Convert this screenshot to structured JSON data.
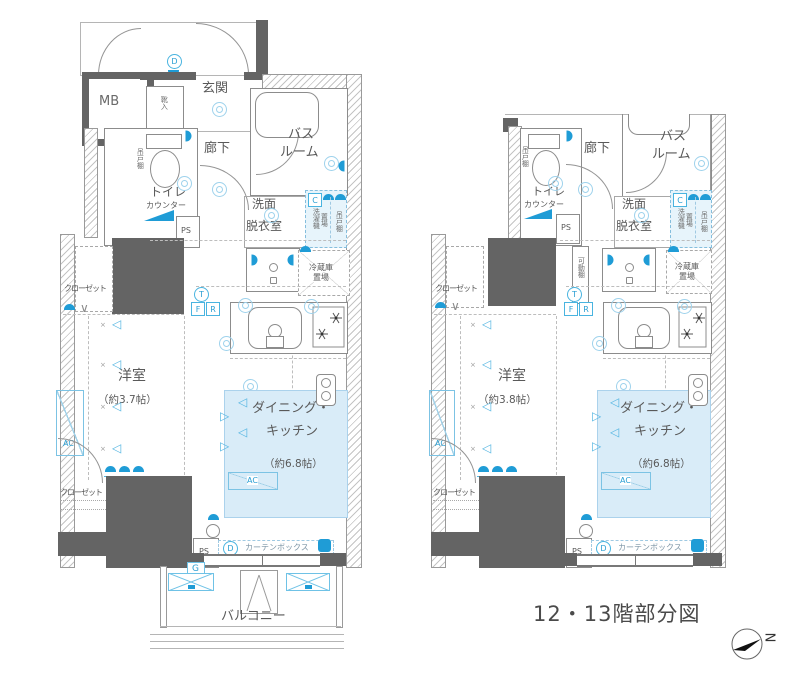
{
  "caption": "12・13階部分図",
  "compass": {
    "label": "N"
  },
  "glyphs": {
    "sconce": "◁",
    "cross": "×",
    "check": "∨"
  },
  "labels": {
    "mb": "MB",
    "entrance": "玄関",
    "shoe_box": "靴入",
    "corridor": "廊下",
    "bath_1": "バス",
    "bath_2": "ルーム",
    "toilet": "トイレ",
    "counter": "カウンター",
    "ps": "PS",
    "wash_1": "洗面",
    "wash_2": "脱衣室",
    "c_mark": "C",
    "washer_1": "洗濯機",
    "washer_2": "置場",
    "hanging_shelf": "吊戸棚",
    "fridge_1": "冷蔵庫",
    "fridge_2": "置場",
    "movable_shelf": "可動棚",
    "closet": "クローゼット",
    "western_room": "洋室",
    "dk_1": "ダイニング・",
    "dk_2": "キッチン",
    "ac": "AC",
    "curtain_box": "カーテンボックス",
    "g_mark": "G",
    "balcony": "バルコニー",
    "t_mark": "T",
    "f_mark": "F",
    "r_mark": "R",
    "d_mark": "D"
  },
  "left_plan": {
    "western_room_area": "（約3.7帖）",
    "dk_area": "（約6.8帖）"
  },
  "right_plan": {
    "western_room_area": "（約3.8帖）",
    "dk_area": "（約6.8帖）"
  },
  "colors": {
    "wall": "#646464",
    "accent_blue": "#1f9cd6",
    "light_blue": "#56b6e2",
    "dk_fill": "#d9ecf8"
  }
}
